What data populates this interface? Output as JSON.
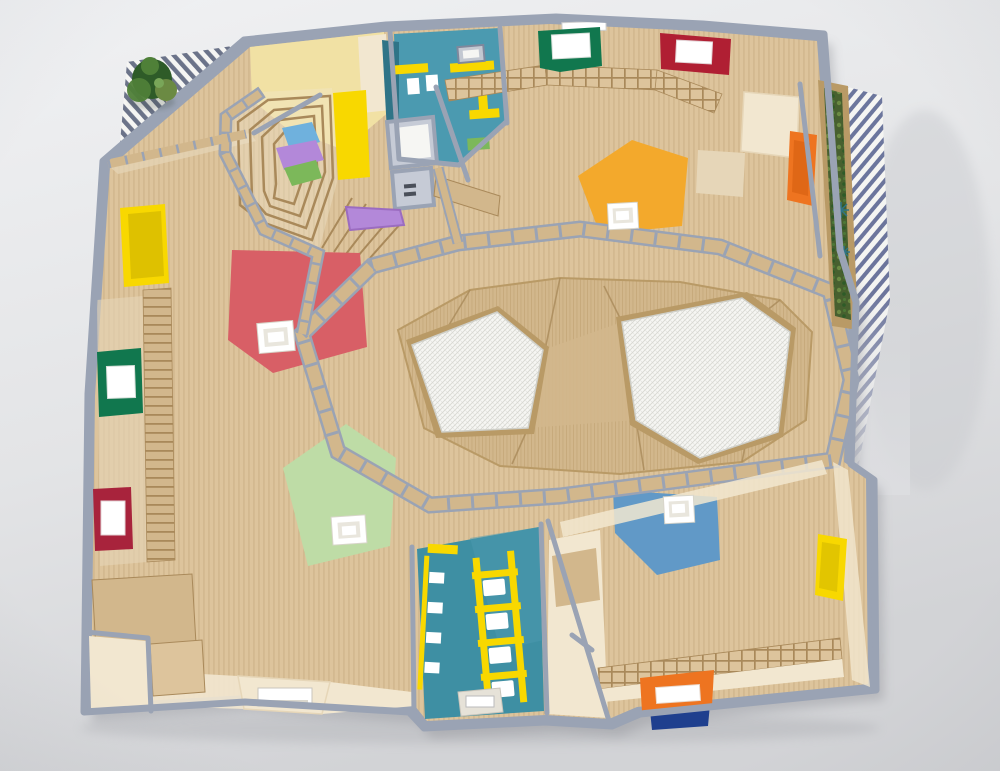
{
  "scene": {
    "kind": "photograph",
    "subject": "architectural scale model of a kindergarten floor plan",
    "view": "top-down"
  },
  "regions": [
    {
      "name": "entry-hall-northwest"
    },
    {
      "name": "stepped-amphitheatre"
    },
    {
      "name": "washroom-north"
    },
    {
      "name": "playroom-east"
    },
    {
      "name": "central-hall-with-skylights"
    },
    {
      "name": "playroom-southwest"
    },
    {
      "name": "washroom-south"
    },
    {
      "name": "playroom-southeast"
    },
    {
      "name": "roof-terrace-planter"
    },
    {
      "name": "louvred-pergola"
    }
  ],
  "palette": {
    "backdrop": "#f0f1f3",
    "backdrop_mid": "#e3e4e6",
    "backdrop_shade": "#d2d3d6",
    "wall": "#9aa3b4",
    "wall_light": "#c6cbd6",
    "wall_deep": "#7f889c",
    "wood": "#ddc49c",
    "wood_stripe": "#cdb287",
    "wood_mid": "#d2b78c",
    "wood_dark": "#b99a66",
    "wood_deep": "#a9895a",
    "cream": "#f2e7d0",
    "cream_dark": "#e6d6b8",
    "pale_yellow": "#f1e1a4",
    "yellow": "#f8d800",
    "yellow_shade": "#d9bd00",
    "red_rug": "#d85f66",
    "maroon": "#a8233c",
    "crimson": "#b01f33",
    "green_dark": "#11774e",
    "green_rug": "#bedca6",
    "grass": "#7cb85a",
    "moss": "#47602f",
    "moss_light": "#6b8a43",
    "tree": "#2e5b28",
    "tree_light": "#4f8038",
    "amber": "#f3a92c",
    "blue_rug": "#6199c7",
    "sky": "#6fb1dd",
    "teal": "#4b9ab0",
    "teal_deep": "#3e8fa3",
    "teal_dark": "#2f7487",
    "orange": "#ee7420",
    "orange_deep": "#d55f10",
    "purple": "#b388d9",
    "purple_deep": "#9b6cc0",
    "navy": "#1f3f8e",
    "white": "#ffffff",
    "off_white": "#f6f6f3",
    "hatch_line": "#d8d8d2",
    "stripe_blue": "#667099",
    "stripe_dark": "#5d657e",
    "glass_gray": "#c3c8d1"
  }
}
